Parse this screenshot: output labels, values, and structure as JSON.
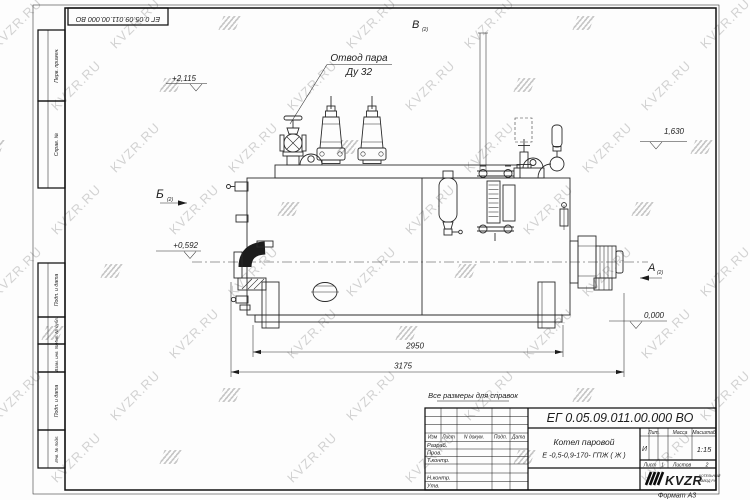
{
  "watermark": {
    "text": "KVZR.RU"
  },
  "frame": {
    "corner_stamp": "ЕГ 0.05.09.011.00.000  ВО",
    "margin": {
      "perv": "Перв. примен.",
      "sprav": "Справ. №",
      "podp_data1": "Подп. и дата",
      "inv_dubl": "Инв. № дубл.",
      "vzam_inv": "Взам. инв. №",
      "podp_data2": "Подп. и дата",
      "inv_podl": "Инв. № подл."
    }
  },
  "drawing": {
    "note": "Все размеры для справок",
    "steam_label1": "Отвод пара",
    "steam_label2": "Ду 32",
    "view_b": "Б",
    "view_v": "В",
    "view_a": "А",
    "view_sub": "(2)",
    "elev_top": "+2,115",
    "elev_right": "1,630",
    "elev_left": "+0,592",
    "elev_zero": "0,000",
    "dim_inner": "2950",
    "dim_overall": "3175"
  },
  "titleblock": {
    "doc_number": "ЕГ 0.05.09.011.00.000  ВО",
    "product1": "Котел паровой",
    "product2": "Е -0,5-0,9-170- ГПЖ ( Ж )",
    "col_izm": "Изм",
    "col_list": "Лист",
    "col_ndokum": "N докум.",
    "col_podp": "Подп.",
    "col_data": "Дата",
    "row_razrab": "Разраб.",
    "row_prov": "Пров.",
    "row_tkontr": "Т.контр.",
    "row_nkontr": "Н.контр.",
    "row_utv": "Утв.",
    "lit_label": "Лит.",
    "lit_value": "И",
    "mass_label": "Масса",
    "scale_label": "Масштаб",
    "scale_value": "1:15",
    "sheet_label": "Лист",
    "sheet_value": "1",
    "sheets_label": "Листов",
    "sheets_value": "2",
    "logo": "KVZR",
    "logo_sub1": "КОТЕЛЬНЫЙ",
    "logo_sub2": "ЗАВОД РУ",
    "format": "Формат А3"
  }
}
